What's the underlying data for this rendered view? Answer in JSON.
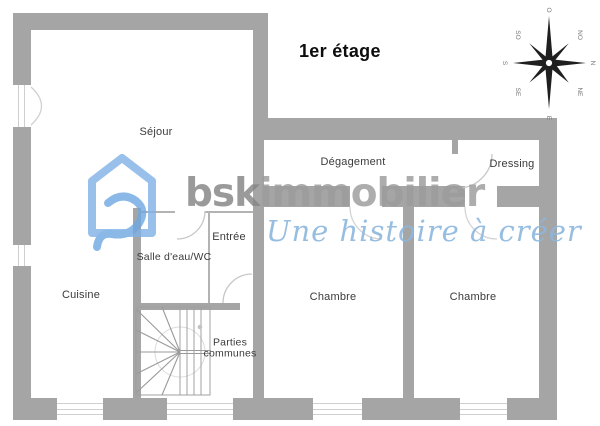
{
  "title": "1er étage",
  "rooms": [
    {
      "label": "Séjour"
    },
    {
      "label": "Cuisine"
    },
    {
      "label": "Salle d'eau/WC"
    },
    {
      "label": "Entrée"
    },
    {
      "label": "Dégagement"
    },
    {
      "label": "Dressing"
    },
    {
      "label": "Chambre"
    },
    {
      "label": "Chambre"
    },
    {
      "label": "Parties communes"
    }
  ],
  "watermark": {
    "brand_bold": "bsk",
    "brand_light": "immobilier",
    "tagline": "Une histoire à créer",
    "house_color": "#7fb1e6",
    "swirl_color": "#6fa8e2",
    "brand_bold_color": "#858585",
    "brand_light_color": "#9c9c9c",
    "tagline_color": "#8cb7de"
  },
  "compass": {
    "o": "O",
    "n": "N",
    "e": "E",
    "s": "S",
    "no": "NO",
    "ne": "NE",
    "so": "SO",
    "se": "SE"
  },
  "colors": {
    "wall": "#a5a5a5",
    "thin_line": "#b3b3b3",
    "arc_line": "#c7c7c7",
    "label_text": "#3b3b3b",
    "compass_dark": "#1f1f1f"
  }
}
